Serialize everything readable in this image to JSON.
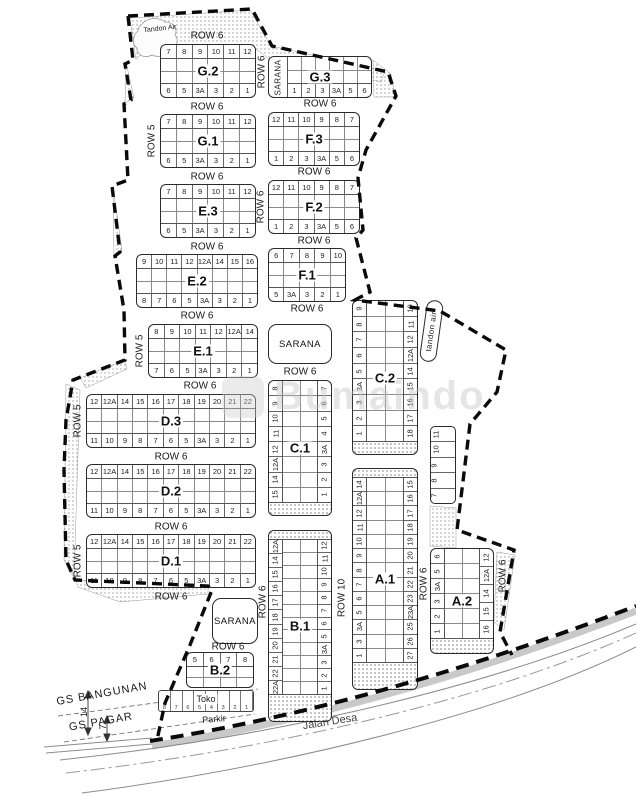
{
  "watermark": {
    "text": "Bumaindo"
  },
  "annotations": {
    "tandon_air_top": "Tandon Air",
    "tandon_air_right": "tandon air",
    "gs_bangunan": "GS BANGUNAN",
    "gs_pagar": "GS PAGAR",
    "jalan_desa": "Jalan Desa",
    "parkir": "Parkir",
    "dim_building": "14",
    "dim_fence": "7"
  },
  "h_blocks": [
    {
      "label": "G.2",
      "x": 160,
      "y": 44,
      "w": 96,
      "h": 54,
      "top": [
        "7",
        "8",
        "9",
        "10",
        "11",
        "12"
      ],
      "bottom": [
        "6",
        "5",
        "3A",
        "3",
        "2",
        "1"
      ]
    },
    {
      "label": "G.3",
      "x": 268,
      "y": 56,
      "w": 104,
      "h": 42,
      "side": "SARANA",
      "top": [],
      "bottom": [
        "1",
        "2",
        "3",
        "3A",
        "5",
        "6"
      ]
    },
    {
      "label": "G.1",
      "x": 160,
      "y": 114,
      "w": 96,
      "h": 54,
      "top": [
        "7",
        "8",
        "9",
        "10",
        "11",
        "12"
      ],
      "bottom": [
        "6",
        "5",
        "3A",
        "3",
        "2",
        "1"
      ]
    },
    {
      "label": "F.3",
      "x": 268,
      "y": 112,
      "w": 92,
      "h": 54,
      "top": [
        "12",
        "11",
        "10",
        "9",
        "8",
        "7"
      ],
      "bottom": [
        "1",
        "2",
        "3",
        "3A",
        "5",
        "6"
      ]
    },
    {
      "label": "E.3",
      "x": 160,
      "y": 184,
      "w": 96,
      "h": 54,
      "top": [
        "7",
        "8",
        "9",
        "10",
        "11",
        "12"
      ],
      "bottom": [
        "6",
        "5",
        "3A",
        "3",
        "2",
        "1"
      ]
    },
    {
      "label": "F.2",
      "x": 268,
      "y": 180,
      "w": 92,
      "h": 54,
      "top": [
        "12",
        "11",
        "10",
        "9",
        "8",
        "7"
      ],
      "bottom": [
        "1",
        "2",
        "3",
        "3A",
        "5",
        "6"
      ]
    },
    {
      "label": "E.2",
      "x": 136,
      "y": 254,
      "w": 122,
      "h": 54,
      "top": [
        "9",
        "10",
        "11",
        "12",
        "12A",
        "14",
        "15",
        "16"
      ],
      "bottom": [
        "8",
        "7",
        "6",
        "5",
        "3A",
        "3",
        "2",
        "1"
      ]
    },
    {
      "label": "F.1",
      "x": 268,
      "y": 248,
      "w": 78,
      "h": 54,
      "top": [
        "6",
        "7",
        "8",
        "9",
        "10"
      ],
      "bottom": [
        "5",
        "3A",
        "3",
        "2",
        "1"
      ]
    },
    {
      "label": "E.1",
      "x": 148,
      "y": 324,
      "w": 110,
      "h": 54,
      "top": [
        "8",
        "9",
        "10",
        "11",
        "12",
        "12A",
        "14"
      ],
      "bottom": [
        "7",
        "6",
        "5",
        "3A",
        "3",
        "2",
        "1"
      ]
    },
    {
      "label": "D.3",
      "x": 86,
      "y": 394,
      "w": 170,
      "h": 54,
      "top": [
        "12",
        "12A",
        "14",
        "15",
        "16",
        "17",
        "18",
        "19",
        "20",
        "21",
        "22"
      ],
      "bottom": [
        "11",
        "10",
        "9",
        "8",
        "7",
        "6",
        "5",
        "3A",
        "3",
        "2",
        "1"
      ]
    },
    {
      "label": "D.2",
      "x": 86,
      "y": 464,
      "w": 170,
      "h": 54,
      "top": [
        "12",
        "12A",
        "14",
        "15",
        "16",
        "17",
        "18",
        "19",
        "20",
        "21",
        "22"
      ],
      "bottom": [
        "11",
        "10",
        "9",
        "8",
        "7",
        "6",
        "5",
        "3A",
        "3",
        "2",
        "1"
      ]
    },
    {
      "label": "D.1",
      "x": 86,
      "y": 534,
      "w": 170,
      "h": 54,
      "top": [
        "12",
        "12A",
        "14",
        "15",
        "16",
        "17",
        "18",
        "19",
        "20",
        "21",
        "22"
      ],
      "bottom": [
        "11",
        "10",
        "9",
        "8",
        "7",
        "6",
        "5",
        "3A",
        "3",
        "2",
        "1"
      ]
    },
    {
      "label": "B.2",
      "x": 186,
      "y": 652,
      "w": 68,
      "h": 36,
      "top": [
        "5",
        "6",
        "7",
        "8"
      ],
      "bottom": []
    }
  ],
  "v_blocks": [
    {
      "label": "C.1",
      "x": 268,
      "y": 380,
      "w": 64,
      "h": 136,
      "hb": 12,
      "left": [
        "8",
        "9",
        "10",
        "11",
        "12",
        "12A",
        "14",
        "15"
      ],
      "right": [
        "7",
        "6",
        "5",
        "4",
        "3A",
        "3",
        "2",
        "1"
      ]
    },
    {
      "label": "C.2",
      "x": 352,
      "y": 300,
      "w": 66,
      "h": 155,
      "hb": 12,
      "left": [
        "9",
        "8",
        "7",
        "6",
        "5",
        "3A",
        "3",
        "2",
        "1"
      ],
      "right": [
        "10",
        "11",
        "12",
        "12A",
        "14",
        "15",
        "16",
        "17",
        "18"
      ]
    },
    {
      "label": "B.1",
      "x": 268,
      "y": 530,
      "w": 64,
      "h": 192,
      "ht": 8,
      "hb": 26,
      "left": [
        "12A",
        "14",
        "15",
        "16",
        "17",
        "18",
        "19",
        "20",
        "21",
        "22",
        "22A"
      ],
      "right": [
        "12",
        "11",
        "10",
        "9",
        "8",
        "7",
        "6",
        "5",
        "3A",
        "3",
        "2",
        "1"
      ]
    },
    {
      "label": "A.1",
      "x": 352,
      "y": 468,
      "w": 66,
      "h": 222,
      "ht": 8,
      "hb": 26,
      "left": [
        "14",
        "12A",
        "12",
        "11",
        "10",
        "9",
        "8",
        "7",
        "6",
        "5",
        "3A",
        "3",
        "1"
      ],
      "right": [
        "15",
        "16",
        "17",
        "18",
        "19",
        "20",
        "21",
        "22",
        "23",
        "23A",
        "25",
        "26",
        "27"
      ]
    },
    {
      "label": "A.2",
      "x": 430,
      "y": 548,
      "w": 64,
      "h": 106,
      "hb": 14,
      "left": [
        "6",
        "5",
        "3A",
        "3",
        "2",
        "1"
      ],
      "right": [
        "12",
        "12A",
        "14",
        "15",
        "16"
      ]
    }
  ],
  "strip": {
    "x": 430,
    "y": 426,
    "w": 26,
    "h": 78,
    "cells": [
      "11",
      "10",
      "9",
      "8",
      "7"
    ]
  },
  "toko_strip": {
    "x": 158,
    "y": 690,
    "w": 96,
    "h": 22,
    "label": "Toko",
    "cells": [
      "8",
      "7",
      "6",
      "5",
      "4",
      "3",
      "2",
      "1"
    ]
  },
  "sarana_boxes": [
    {
      "label": "SARANA",
      "x": 268,
      "y": 324,
      "w": 64,
      "h": 40
    },
    {
      "label": "SARANA",
      "x": 212,
      "y": 598,
      "w": 46,
      "h": 46
    }
  ],
  "tandon_box": {
    "label": "tandon air",
    "x": 423,
    "y": 300,
    "w": 17,
    "h": 62,
    "rot": 8
  },
  "free_labels": [
    {
      "text": "ROW 6",
      "x": 207,
      "y": 36,
      "rot": 0,
      "fs": 10
    },
    {
      "text": "ROW 6",
      "x": 320,
      "y": 104,
      "rot": 0,
      "fs": 10
    },
    {
      "text": "ROW 6",
      "x": 207,
      "y": 107,
      "rot": 0,
      "fs": 10
    },
    {
      "text": "ROW 6",
      "x": 207,
      "y": 177,
      "rot": 0,
      "fs": 10
    },
    {
      "text": "ROW 6",
      "x": 314,
      "y": 172,
      "rot": 0,
      "fs": 10
    },
    {
      "text": "ROW 6",
      "x": 207,
      "y": 247,
      "rot": 0,
      "fs": 10
    },
    {
      "text": "ROW 6",
      "x": 314,
      "y": 241,
      "rot": 0,
      "fs": 10
    },
    {
      "text": "ROW 6",
      "x": 197,
      "y": 316,
      "rot": 0,
      "fs": 10
    },
    {
      "text": "ROW 6",
      "x": 307,
      "y": 309,
      "rot": 0,
      "fs": 10
    },
    {
      "text": "ROW 6",
      "x": 200,
      "y": 386,
      "rot": 0,
      "fs": 10
    },
    {
      "text": "ROW 6",
      "x": 300,
      "y": 372,
      "rot": 0,
      "fs": 10
    },
    {
      "text": "ROW 6",
      "x": 171,
      "y": 457,
      "rot": 0,
      "fs": 10
    },
    {
      "text": "ROW 6",
      "x": 171,
      "y": 527,
      "rot": 0,
      "fs": 10
    },
    {
      "text": "ROW 6",
      "x": 171,
      "y": 597,
      "rot": 0,
      "fs": 10
    },
    {
      "text": "ROW 6",
      "x": 228,
      "y": 647,
      "rot": 0,
      "fs": 10
    },
    {
      "text": "ROW 6",
      "x": 262,
      "y": 72,
      "rot": -90,
      "fs": 10
    },
    {
      "text": "ROW 5",
      "x": 152,
      "y": 141,
      "rot": -90,
      "fs": 10
    },
    {
      "text": "ROW 6",
      "x": 261,
      "y": 207,
      "rot": -90,
      "fs": 10
    },
    {
      "text": "ROW 5",
      "x": 140,
      "y": 351,
      "rot": -90,
      "fs": 10
    },
    {
      "text": "ROW 5",
      "x": 78,
      "y": 421,
      "rot": -90,
      "fs": 10
    },
    {
      "text": "ROW 5",
      "x": 78,
      "y": 561,
      "rot": -90,
      "fs": 10
    },
    {
      "text": "ROW 10",
      "x": 342,
      "y": 598,
      "rot": -90,
      "fs": 10
    },
    {
      "text": "ROW 6",
      "x": 424,
      "y": 584,
      "rot": -90,
      "fs": 10
    },
    {
      "text": "ROW 6",
      "x": 503,
      "y": 576,
      "rot": -90,
      "fs": 10
    },
    {
      "text": "ROW 6",
      "x": 263,
      "y": 602,
      "rot": -90,
      "fs": 10
    },
    {
      "text": "Tandon Air",
      "x": 160,
      "y": 29,
      "rot": -6,
      "fs": 7
    },
    {
      "text": "GS BANGUNAN",
      "x": 102,
      "y": 694,
      "rot": -10,
      "fs": 11,
      "ls": 1
    },
    {
      "text": "GS PAGAR",
      "x": 101,
      "y": 722,
      "rot": -10,
      "fs": 11,
      "ls": 1
    },
    {
      "text": "Jalan Desa",
      "x": 330,
      "y": 722,
      "rot": -9,
      "fs": 11,
      "color": "#444"
    },
    {
      "text": "Parkir",
      "x": 214,
      "y": 719,
      "rot": -5,
      "fs": 9
    },
    {
      "text": "14",
      "x": 84,
      "y": 712,
      "rot": -90,
      "fs": 9
    },
    {
      "text": "7",
      "x": 103,
      "y": 727,
      "rot": -90,
      "fs": 9
    }
  ]
}
